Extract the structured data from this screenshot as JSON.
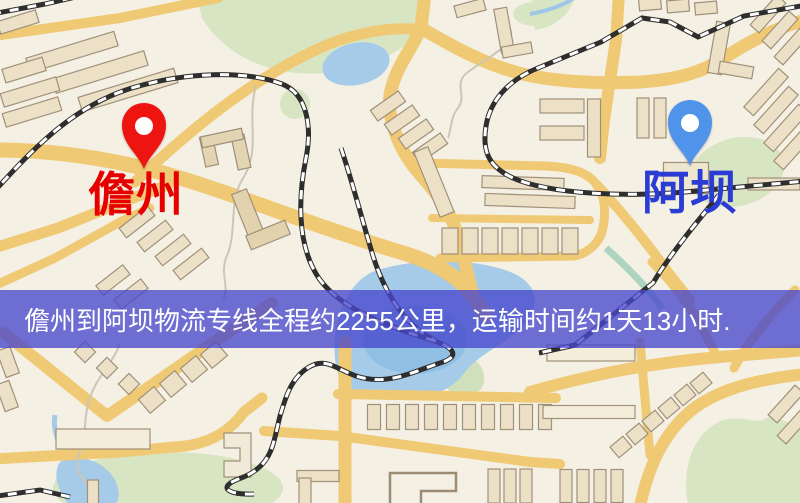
{
  "origin": {
    "label": "儋州",
    "marker_color": "#ee1410",
    "label_color": "#e60000"
  },
  "destination": {
    "label": "阿坝",
    "marker_color": "#4f94ea",
    "label_color": "#2a3cd4"
  },
  "banner": {
    "text": "儋州到阿坝物流专线全程约2255公里，运输时间约1天13小时.",
    "distance_km": "2255",
    "duration": "1天13小时",
    "background_color": "#4848cd",
    "text_color": "#ffffff"
  },
  "map_colors": {
    "background": "#f5f0e4",
    "road": "#efc974",
    "park": "#d7e5c2",
    "water": "#a5cbe9",
    "building": "#ece1c7",
    "railway": "#2e2e2e"
  }
}
